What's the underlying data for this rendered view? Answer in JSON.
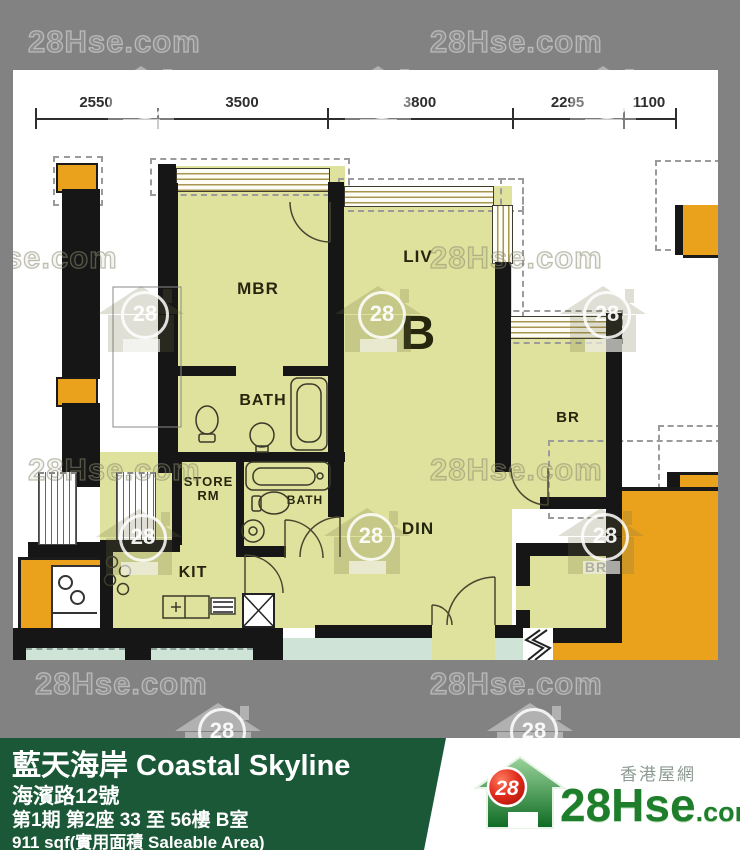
{
  "watermark": {
    "text": "28Hse.com",
    "badge": "28"
  },
  "dimensions": [
    "2550",
    "3500",
    "3800",
    "2295",
    "1100"
  ],
  "rooms": {
    "mbr": "MBR",
    "liv": "LIV",
    "unit_label": "B",
    "bath_upper": "BATH",
    "bath_lower": "BATH",
    "store_line1": "STORE",
    "store_line2": "RM",
    "kit": "KIT",
    "din": "DIN",
    "br_upper": "BR",
    "br_lower": "BR"
  },
  "footer": {
    "title": "藍天海岸 Coastal Skyline",
    "address": "海濱路12號",
    "block_info": "第1期 第2座 33 至 56樓 B室",
    "area": "911 sqf(實用面積 Saleable Area)"
  },
  "logo": {
    "name": "28Hse",
    "tld": ".com",
    "tagline": "香港屋網",
    "badge": "28"
  },
  "colors": {
    "background_gray": "#828282",
    "room_fill": "#dee29c",
    "neighbor_orange": "#eaa21d",
    "corridor_teal": "#cfe3d6",
    "footer_green": "#1a5838",
    "logo_green": "#1e7e2c",
    "logo_red": "#d42113"
  }
}
